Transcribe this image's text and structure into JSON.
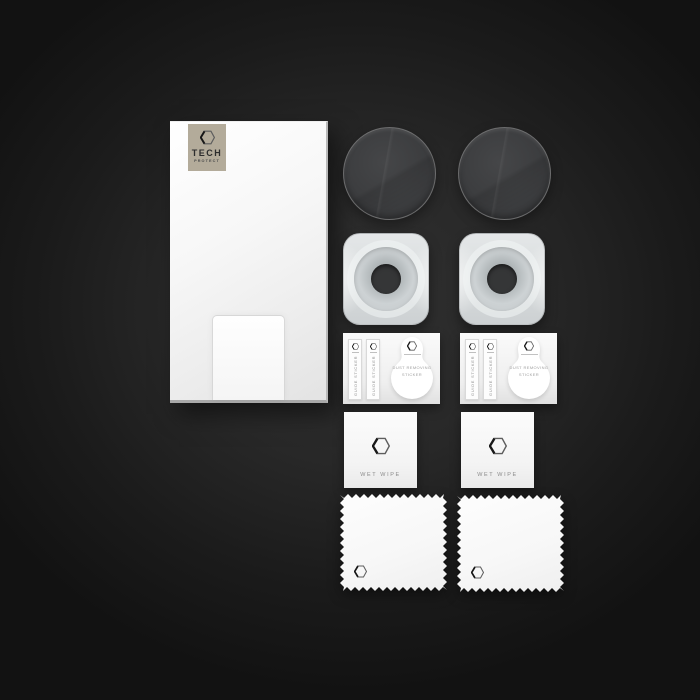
{
  "scene": {
    "description": "Flat-lay product photo of a camera lens tempered glass protector kit on a dark vignette background",
    "background_center_color": "#313131",
    "background_edge_color": "#121212"
  },
  "brand": {
    "name": "TECH",
    "subname": "PROTECT",
    "badge_color": "#b3ab9a",
    "logo_icon": "hexagon-icon"
  },
  "labels": {
    "guide_sticker": "GUIDE STICKER",
    "dust_removing_line1": "DUST REMOVING",
    "dust_removing_line2": "STICKER",
    "wet_wipe": "WET WIPE"
  },
  "kit_contents": {
    "protector_envelope_count": 1,
    "lens_glass_count": 2,
    "applicator_tray_count": 2,
    "sticker_sheet_count": 2,
    "guide_sticker_strips_per_sheet": 2,
    "wet_wipe_count": 2,
    "microfiber_cloth_count": 2
  },
  "colors": {
    "lens_glass": "#3c3d3f",
    "applicator_tray": "#d8dcdd",
    "card_white": "#f7f7f7",
    "envelope_white": "#f5f5f5"
  }
}
